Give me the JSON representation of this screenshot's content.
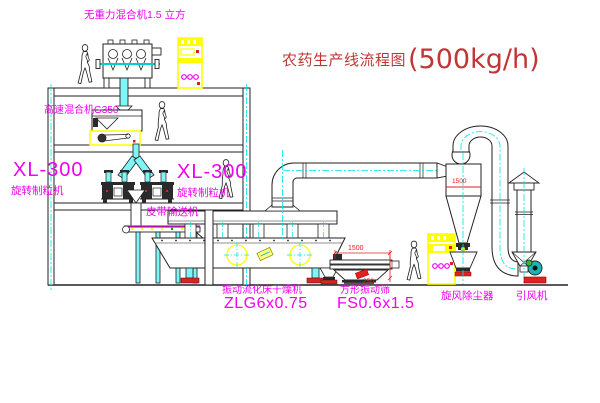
{
  "title": {
    "name": "农药生产线流程图",
    "capacity": "(500kg/h)"
  },
  "labels": {
    "gravity_mixer": "无重力混合机1.5 立方",
    "high_speed_mixer": "高速混合机G350",
    "granulator_left_model": "XL-300",
    "granulator_left_name": "旋转制粒机",
    "granulator_right_model": "XL-300",
    "granulator_right_name": "旋转制粒机",
    "belt_conveyor": "皮带输送机",
    "dryer_name": "振动流化床干燥机",
    "dryer_model": "ZLG6x0.75",
    "sifter_name": "方形振动筛",
    "sifter_model": "FS0.6x1.5",
    "cyclone": "旋风除尘器",
    "fan": "引风机"
  },
  "dimensions": {
    "cyclone_dim": "1500",
    "sifter_length": "1500",
    "sifter_height": "250"
  },
  "colors": {
    "label": "#F000F0",
    "title": "#C23535",
    "centerline": "#00E5E5",
    "cabinet": "#FFFF00",
    "dimension": "#E02020"
  }
}
